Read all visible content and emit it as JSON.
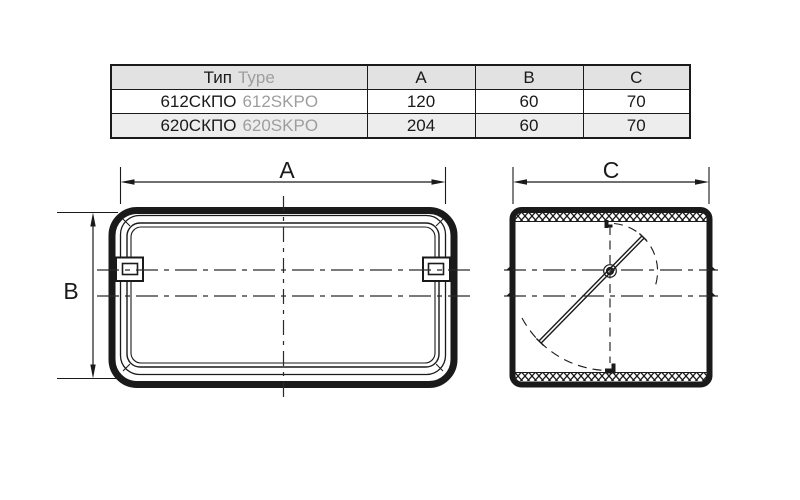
{
  "table": {
    "header": {
      "type_ru": "Тип",
      "type_en": "Type",
      "col_a": "A",
      "col_b": "B",
      "col_c": "C"
    },
    "rows": [
      {
        "type_ru": "612СКПО",
        "type_en": "612SKPO",
        "a": "120",
        "b": "60",
        "c": "70"
      },
      {
        "type_ru": "620СКПО",
        "type_en": "620SKPO",
        "a": "204",
        "b": "60",
        "c": "70"
      }
    ]
  },
  "drawings": {
    "front_view": {
      "dim_width_label": "A",
      "dim_height_label": "B"
    },
    "side_view": {
      "dim_depth_label": "C"
    }
  },
  "colors": {
    "line": "#1a1a1a",
    "secondary_text": "#9e9e9e",
    "header_bg": "#e2e2e2",
    "row_alt_bg": "#ededed"
  }
}
